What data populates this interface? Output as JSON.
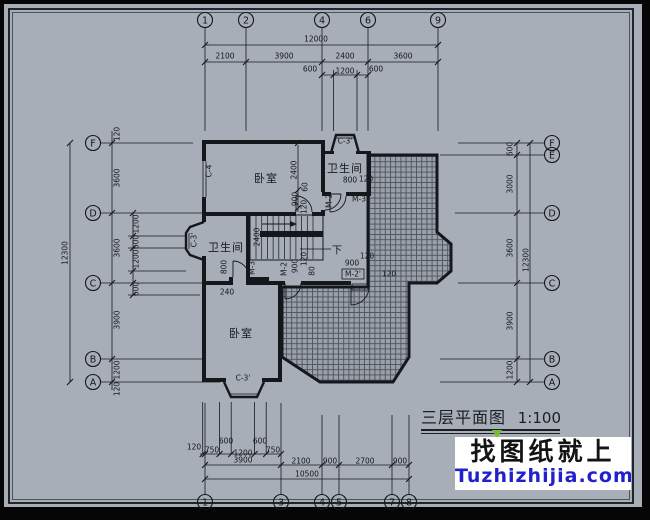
{
  "colors": {
    "paper": "#a7aeb7",
    "ink": "#14171b",
    "hatch_bg": "#99a0aa",
    "hatch_line": "#4d535b",
    "watermark_blue": "#2121cc",
    "watermark_bg": "#ffffff",
    "frame_black": "#060607",
    "green_marker": "#76bf2a"
  },
  "title": {
    "text": "三层平面图",
    "scale": "1:100"
  },
  "watermark": {
    "line1": "找图纸就上",
    "line2": "Tuzhizhijia.com"
  },
  "axes": {
    "top": [
      {
        "label": "1",
        "x": 205
      },
      {
        "label": "2",
        "x": 246
      },
      {
        "label": "4",
        "x": 322
      },
      {
        "label": "6",
        "x": 368
      },
      {
        "label": "9",
        "x": 438
      }
    ],
    "bottom": [
      {
        "label": "1",
        "x": 205
      },
      {
        "label": "3",
        "x": 281
      },
      {
        "label": "4",
        "x": 322
      },
      {
        "label": "5",
        "x": 339
      },
      {
        "label": "7",
        "x": 392
      },
      {
        "label": "8",
        "x": 409
      }
    ],
    "left": [
      {
        "label": "F",
        "y": 143
      },
      {
        "label": "D",
        "y": 213
      },
      {
        "label": "C",
        "y": 283
      },
      {
        "label": "B",
        "y": 359
      },
      {
        "label": "A",
        "y": 382
      }
    ],
    "right": [
      {
        "label": "F",
        "y": 143
      },
      {
        "label": "E",
        "y": 155
      },
      {
        "label": "D",
        "y": 213
      },
      {
        "label": "C",
        "y": 283
      },
      {
        "label": "B",
        "y": 359
      },
      {
        "label": "A",
        "y": 382
      }
    ]
  },
  "rooms": [
    {
      "label": "卧室",
      "x": 266,
      "y": 178
    },
    {
      "label": "卫生间",
      "x": 345,
      "y": 168
    },
    {
      "label": "卫生间",
      "x": 226,
      "y": 247
    },
    {
      "label": "卧室",
      "x": 241,
      "y": 333
    }
  ],
  "stair_note": {
    "label": "下",
    "x": 337,
    "y": 250
  },
  "annotations": [
    {
      "t": "12000",
      "x": 316,
      "y": 39
    },
    {
      "t": "2100",
      "x": 225,
      "y": 56
    },
    {
      "t": "3900",
      "x": 284,
      "y": 56
    },
    {
      "t": "2400",
      "x": 345,
      "y": 56
    },
    {
      "t": "3600",
      "x": 403,
      "y": 56
    },
    {
      "t": "600",
      "x": 310,
      "y": 69
    },
    {
      "t": "1200",
      "x": 345,
      "y": 71
    },
    {
      "t": "600",
      "x": 376,
      "y": 69
    },
    {
      "t": "120",
      "x": 194,
      "y": 447
    },
    {
      "t": "750",
      "x": 212,
      "y": 450
    },
    {
      "t": "600",
      "x": 226,
      "y": 441
    },
    {
      "t": "1200",
      "x": 243,
      "y": 453
    },
    {
      "t": "600",
      "x": 260,
      "y": 441
    },
    {
      "t": "750",
      "x": 273,
      "y": 450
    },
    {
      "t": "3900",
      "x": 243,
      "y": 460
    },
    {
      "t": "2100",
      "x": 301,
      "y": 461
    },
    {
      "t": "900",
      "x": 330,
      "y": 461
    },
    {
      "t": "2700",
      "x": 365,
      "y": 461
    },
    {
      "t": "900",
      "x": 400,
      "y": 461
    },
    {
      "t": "10500",
      "x": 307,
      "y": 474
    },
    {
      "t": "120",
      "x": 117,
      "y": 134,
      "r": 1
    },
    {
      "t": "3600",
      "x": 117,
      "y": 178,
      "r": 1
    },
    {
      "t": "3600",
      "x": 117,
      "y": 248,
      "r": 1
    },
    {
      "t": "3900",
      "x": 117,
      "y": 320,
      "r": 1
    },
    {
      "t": "1200",
      "x": 117,
      "y": 370,
      "r": 1
    },
    {
      "t": "120",
      "x": 117,
      "y": 389,
      "r": 1
    },
    {
      "t": "1200",
      "x": 136,
      "y": 224,
      "r": 1
    },
    {
      "t": "600",
      "x": 136,
      "y": 242,
      "r": 1
    },
    {
      "t": "1200",
      "x": 136,
      "y": 259,
      "r": 1
    },
    {
      "t": "600",
      "x": 136,
      "y": 289,
      "r": 1
    },
    {
      "t": "12300",
      "x": 65,
      "y": 253,
      "r": 1
    },
    {
      "t": "600",
      "x": 510,
      "y": 149,
      "r": 1
    },
    {
      "t": "3000",
      "x": 510,
      "y": 184,
      "r": 1
    },
    {
      "t": "3600",
      "x": 510,
      "y": 248,
      "r": 1
    },
    {
      "t": "3900",
      "x": 510,
      "y": 321,
      "r": 1
    },
    {
      "t": "1200",
      "x": 510,
      "y": 370,
      "r": 1
    },
    {
      "t": "12300",
      "x": 526,
      "y": 260,
      "r": 1
    },
    {
      "t": "2400",
      "x": 294,
      "y": 170,
      "r": 1
    },
    {
      "t": "60",
      "x": 305,
      "y": 187,
      "r": 1
    },
    {
      "t": "900",
      "x": 295,
      "y": 199,
      "r": 1
    },
    {
      "t": "120",
      "x": 304,
      "y": 207,
      "r": 1
    },
    {
      "t": "2400",
      "x": 257,
      "y": 237,
      "r": 1
    },
    {
      "t": "800",
      "x": 350,
      "y": 180
    },
    {
      "t": "120",
      "x": 366,
      "y": 179
    },
    {
      "t": "M-2",
      "x": 329,
      "y": 201,
      "r": 1
    },
    {
      "t": "M-3",
      "x": 359,
      "y": 199
    },
    {
      "t": "800",
      "x": 224,
      "y": 267,
      "r": 1
    },
    {
      "t": "M-3",
      "x": 252,
      "y": 268,
      "r": 1
    },
    {
      "t": "240",
      "x": 227,
      "y": 292
    },
    {
      "t": "M-2",
      "x": 284,
      "y": 269,
      "r": 1
    },
    {
      "t": "900",
      "x": 295,
      "y": 266,
      "r": 1
    },
    {
      "t": "120",
      "x": 304,
      "y": 259,
      "r": 1
    },
    {
      "t": "80",
      "x": 312,
      "y": 271,
      "r": 1
    },
    {
      "t": "900",
      "x": 352,
      "y": 263
    },
    {
      "t": "120",
      "x": 367,
      "y": 256
    },
    {
      "t": "M-2'",
      "x": 353,
      "y": 274,
      "box": 1
    },
    {
      "t": "120",
      "x": 389,
      "y": 274
    },
    {
      "t": "C-4",
      "x": 209,
      "y": 171,
      "r": 1
    },
    {
      "t": "C-3'",
      "x": 345,
      "y": 141
    },
    {
      "t": "C-3'",
      "x": 194,
      "y": 240,
      "r": 1
    },
    {
      "t": "C-3'",
      "x": 243,
      "y": 378
    }
  ]
}
